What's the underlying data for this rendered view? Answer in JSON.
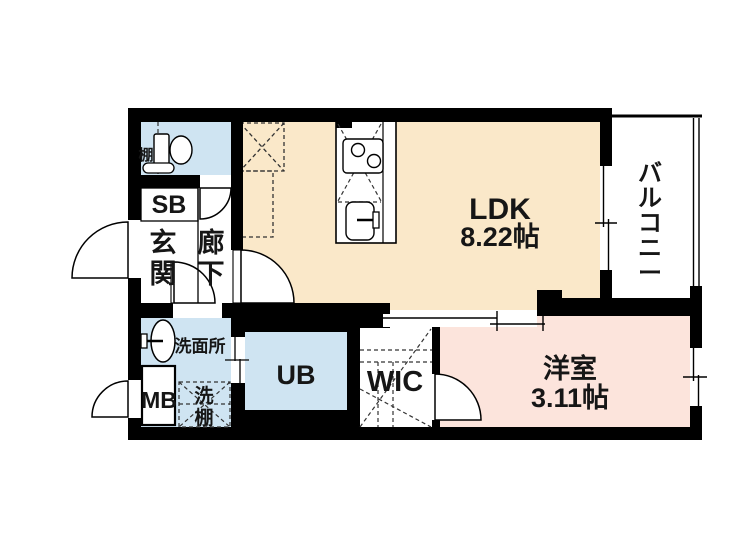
{
  "floor_plan": {
    "rooms": {
      "ldk": {
        "label": "LDK",
        "size": "8.22帖"
      },
      "western_room": {
        "label": "洋室",
        "size": "3.11帖"
      },
      "balcony": {
        "label": "バルコニー"
      },
      "entrance": {
        "label": "玄関"
      },
      "hallway": {
        "label": "廊下"
      },
      "toilet": {
        "shelf_label": "棚"
      },
      "washroom": {
        "label": "洗面所"
      },
      "unit_bath": {
        "label": "UB"
      },
      "walk_in_closet": {
        "label": "WIC"
      },
      "shoe_box": {
        "label": "SB"
      },
      "meter_box": {
        "label": "MB"
      },
      "laundry": {
        "washer_label": "洗",
        "shelf_label": "棚"
      }
    },
    "colors": {
      "ldk": "#FAE8C9",
      "western_room": "#FCE4DC",
      "wet_area": "#CFE4F2",
      "wall": "#000000",
      "background": "#FFFFFF"
    }
  }
}
